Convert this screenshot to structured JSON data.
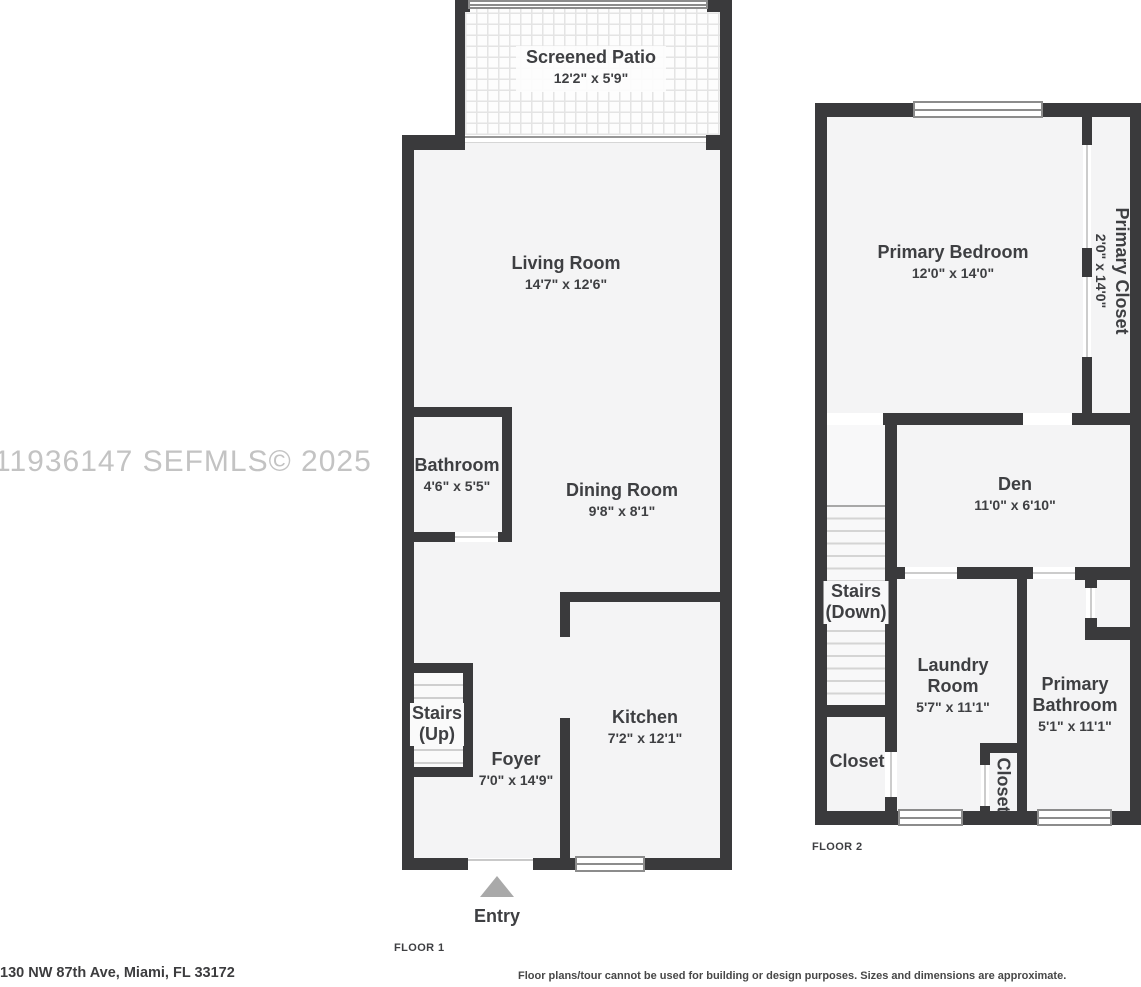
{
  "watermark": "11936147 SEFMLS© 2025",
  "footer": {
    "address": "130 NW 87th Ave, Miami, FL 33172",
    "disclaimer": "Floor plans/tour cannot be used for building or design purposes. Sizes and dimensions are approximate."
  },
  "floor1": {
    "tag": "FLOOR 1",
    "entry": "Entry",
    "rooms": {
      "screened_patio": {
        "name": "Screened Patio",
        "dims": "12'2\" x 5'9\""
      },
      "living_room": {
        "name": "Living Room",
        "dims": "14'7\" x 12'6\""
      },
      "bathroom": {
        "name": "Bathroom",
        "dims": "4'6\" x 5'5\""
      },
      "dining_room": {
        "name": "Dining Room",
        "dims": "9'8\" x 8'1\""
      },
      "stairs": {
        "name": "Stairs",
        "dims": "(Up)"
      },
      "foyer": {
        "name": "Foyer",
        "dims": "7'0\" x 14'9\""
      },
      "kitchen": {
        "name": "Kitchen",
        "dims": "7'2\" x 12'1\""
      }
    }
  },
  "floor2": {
    "tag": "FLOOR 2",
    "rooms": {
      "primary_bedroom": {
        "name": "Primary Bedroom",
        "dims": "12'0\" x 14'0\""
      },
      "primary_closet": {
        "name": "Primary Closet",
        "dims": "2'0\" x 14'0\""
      },
      "den": {
        "name": "Den",
        "dims": "11'0\" x 6'10\""
      },
      "stairs": {
        "name": "Stairs",
        "dims": "(Down)"
      },
      "laundry_room": {
        "name": "Laundry Room",
        "dims": "5'7\" x 11'1\""
      },
      "primary_bathroom": {
        "name": "Primary Bathroom",
        "dims": "5'1\" x 11'1\""
      },
      "closet": {
        "name": "Closet"
      },
      "closet_2": {
        "name": "Closet"
      }
    }
  },
  "colors": {
    "wall": "#3a3a3c",
    "room_fill": "#f4f4f5",
    "text": "#3e3f42",
    "watermark": "#c3c3c3",
    "entry_arrow": "#a9a9a9"
  }
}
